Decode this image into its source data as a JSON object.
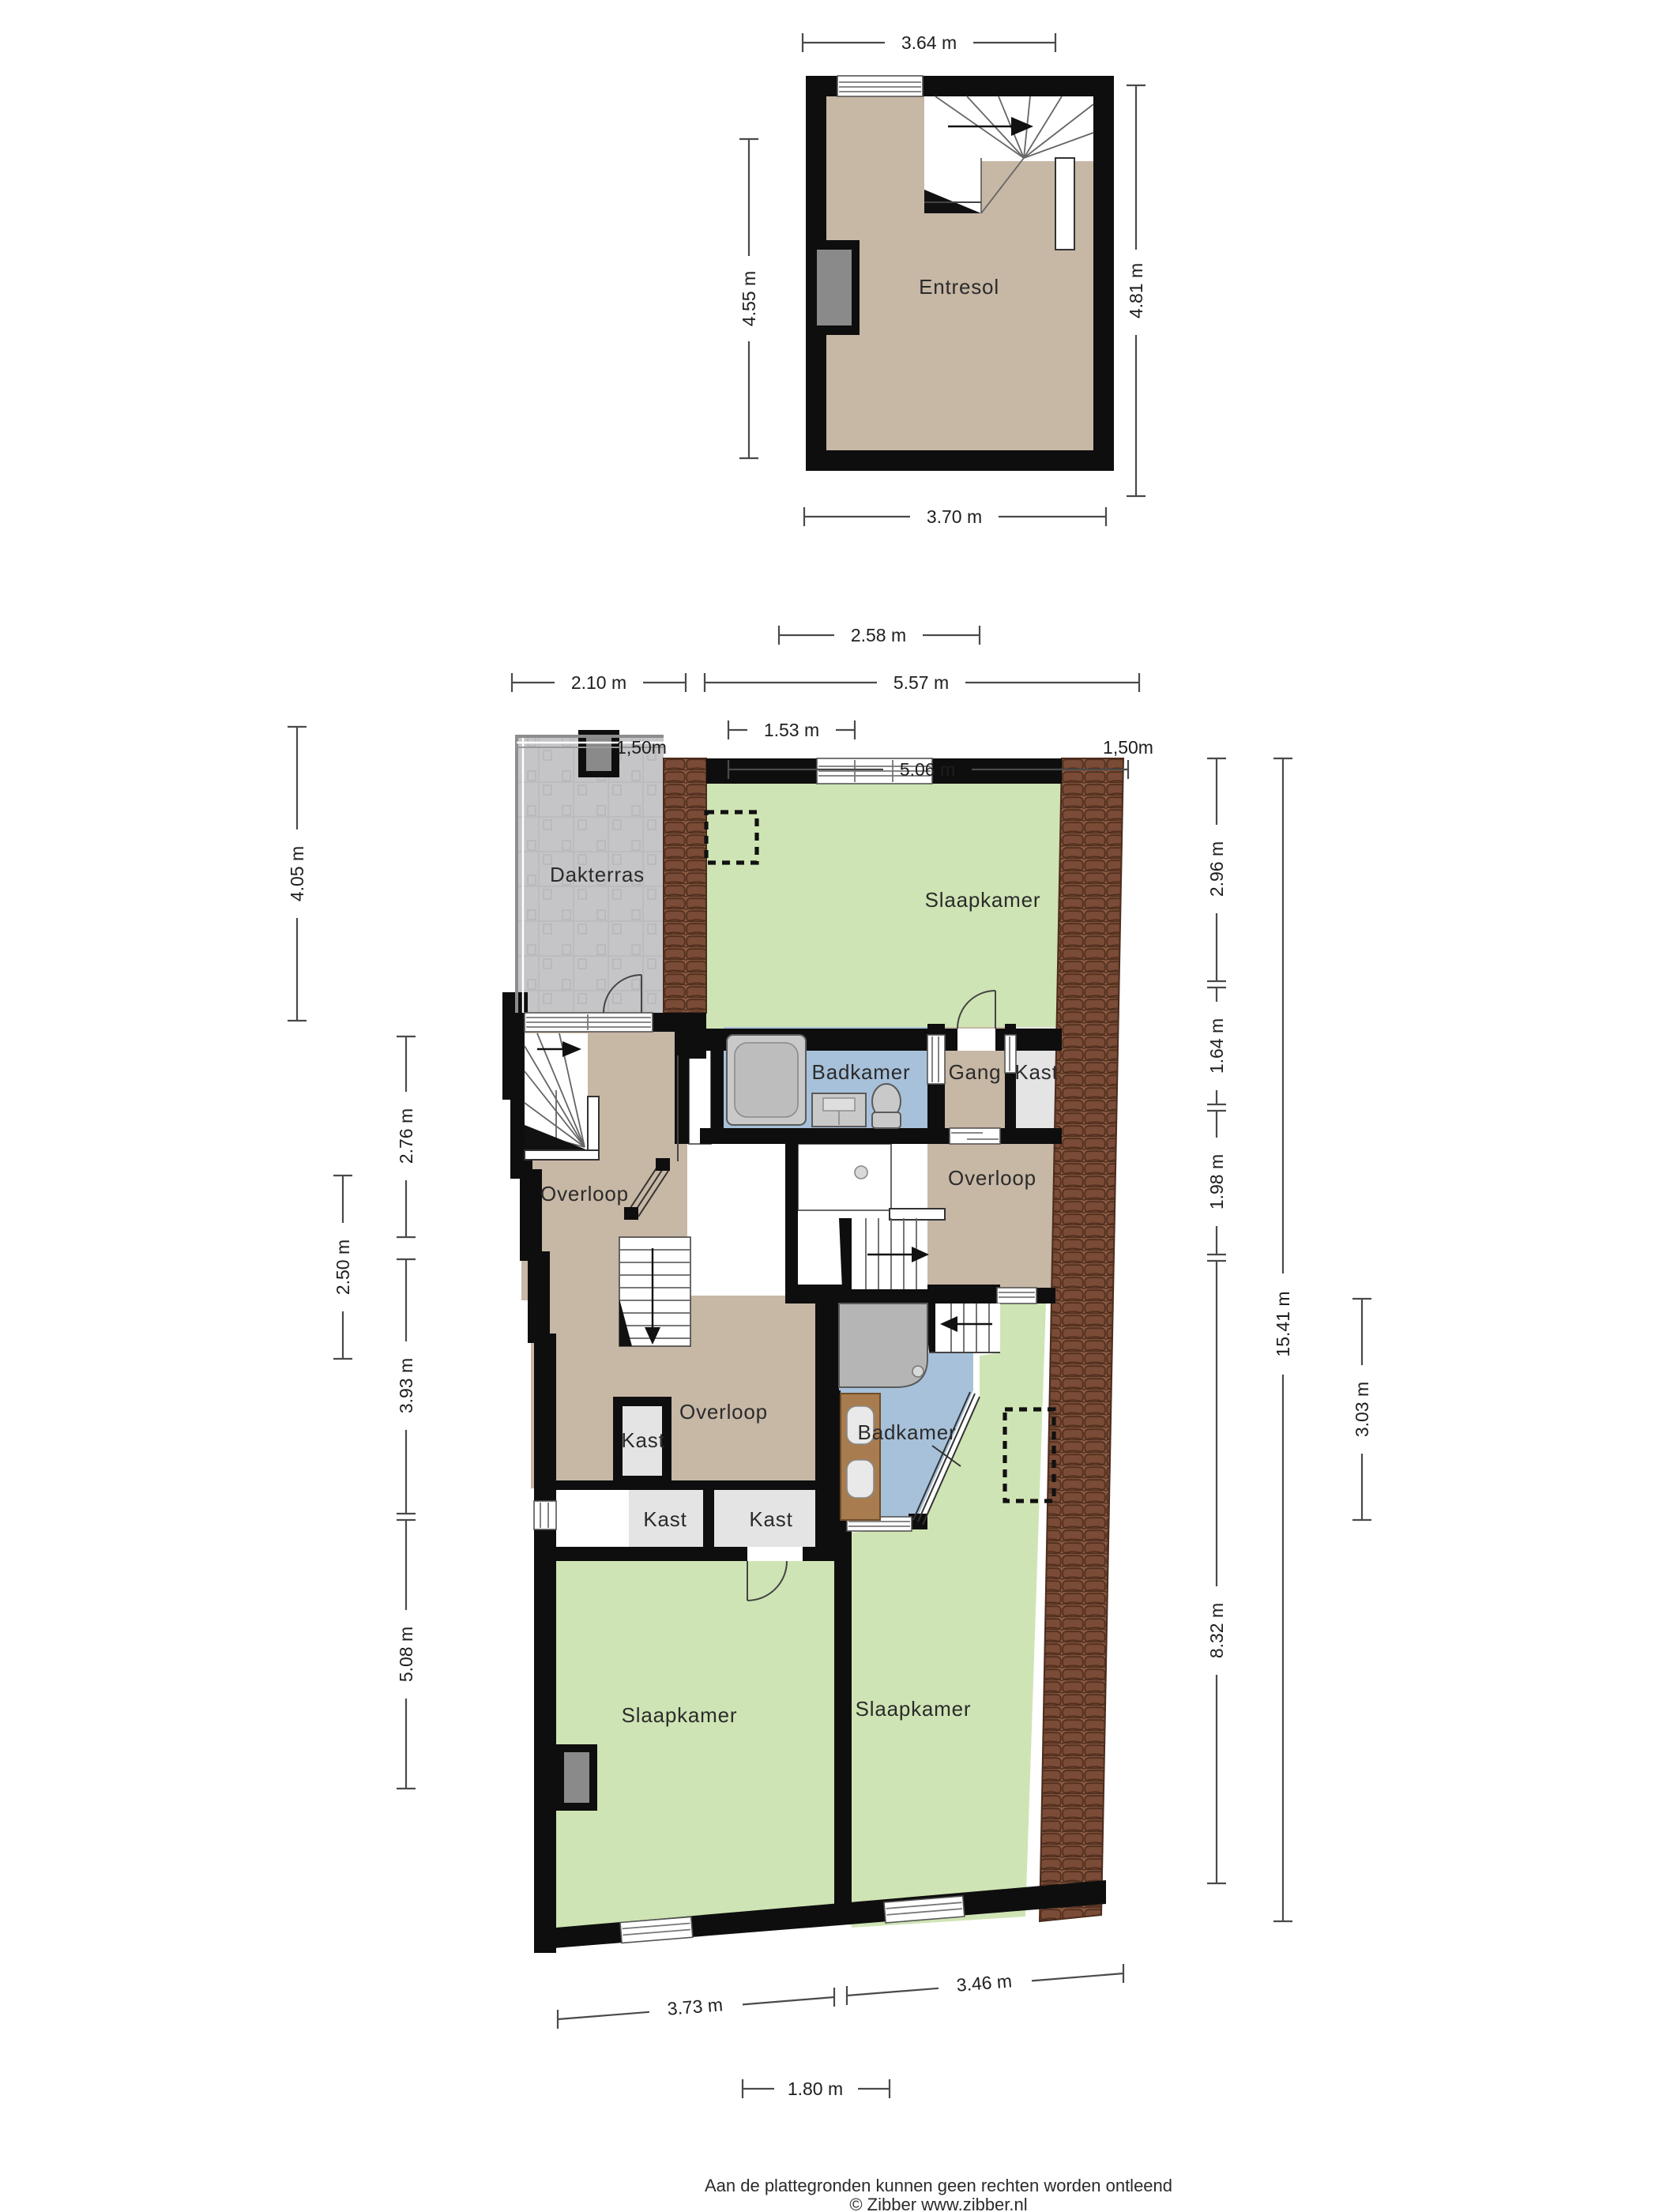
{
  "entresol": {
    "room": "Entresol",
    "dims": {
      "top": "3.64 m",
      "left": "4.55 m",
      "right": "4.81 m",
      "bottom": "3.70 m"
    }
  },
  "floor": {
    "rooms": {
      "dakterras": "Dakterras",
      "slaapkamer_top": "Slaapkamer",
      "badkamer_top": "Badkamer",
      "gang": "Gang",
      "kast_right": "Kast",
      "overloop_topleft": "Overloop",
      "overloop_right": "Overloop",
      "overloop_mid": "Overloop",
      "kast_small": "Kast",
      "kast_a": "Kast",
      "kast_b": "Kast",
      "badkamer_low": "Badkamer",
      "slaapkamer_left": "Slaapkamer",
      "slaapkamer_right": "Slaapkamer"
    },
    "dims": {
      "d258": "2.58 m",
      "d210": "2.10 m",
      "d557": "5.57 m",
      "d153": "1.53 m",
      "d506": "5.06 m",
      "knee_left": "1,50m",
      "knee_right": "1,50m",
      "d405": "4.05 m",
      "d276": "2.76 m",
      "d250": "2.50 m",
      "d393": "3.93 m",
      "d508": "5.08 m",
      "d296": "2.96 m",
      "d164": "1.64 m",
      "d198": "1.98 m",
      "d832": "8.32 m",
      "d1541": "15.41 m",
      "d303": "3.03 m",
      "d373": "3.73 m",
      "d346": "3.46 m",
      "d180": "1.80 m"
    }
  },
  "footer": {
    "line1": "Aan de plattegronden kunnen geen rechten worden ontleend",
    "line2": "© Zibber www.zibber.nl"
  },
  "colors": {
    "wall": "#0e0e0e",
    "room_tan": "#c7b7a5",
    "room_green": "#cfe4b4",
    "room_blue": "#a8c1da",
    "room_kast": "#e4e4e4",
    "terrace": "#c5c5c7",
    "brick": "#7a4b36",
    "dim_line": "#4a4a4a"
  }
}
